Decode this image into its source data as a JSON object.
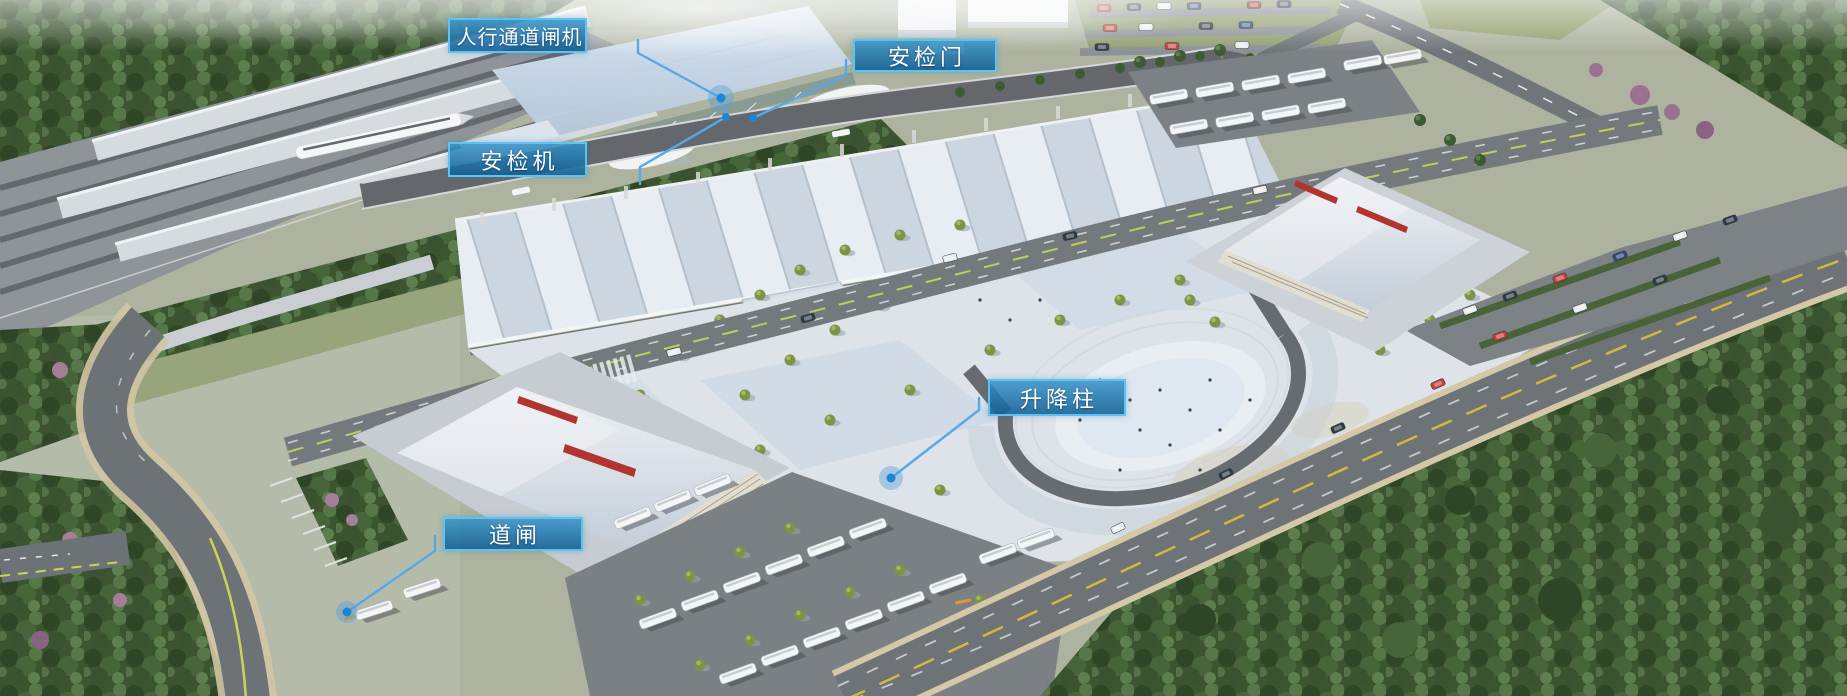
{
  "callouts": [
    {
      "id": "pedestrian-channel-gate",
      "text": "人行通道闸机"
    },
    {
      "id": "security-door",
      "text": "安检门"
    },
    {
      "id": "security-scanner",
      "text": "安检机"
    },
    {
      "id": "lifting-bollard",
      "text": "升降柱"
    },
    {
      "id": "barrier-gate",
      "text": "道闸"
    }
  ],
  "colors": {
    "callout_fill_top": "rgba(52,145,199,0.85)",
    "callout_fill_bottom": "rgba(17,95,150,0.88)",
    "callout_border": "#5fc3f0",
    "callout_text": "#ffffff",
    "leader_line": "#55a9e8",
    "marker_dot": "#1b86d3",
    "marker_halo": "#57a0d8"
  }
}
